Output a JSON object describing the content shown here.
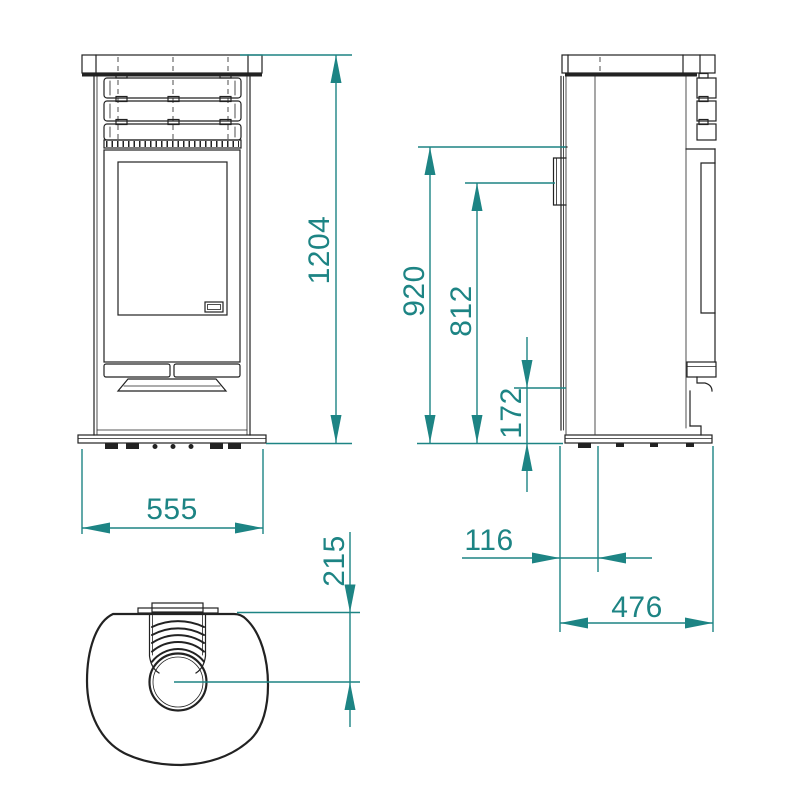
{
  "colors": {
    "accent": "#1d8484",
    "line": "#222222",
    "background": "#ffffff"
  },
  "dims": {
    "front_height": "1204",
    "front_width": "555",
    "rear_flue_top_height": "920",
    "rear_flue_center_height": "812",
    "rear_inlet_height": "172",
    "rear_offset": "116",
    "depth": "476",
    "flue_center_from_back": "215"
  }
}
